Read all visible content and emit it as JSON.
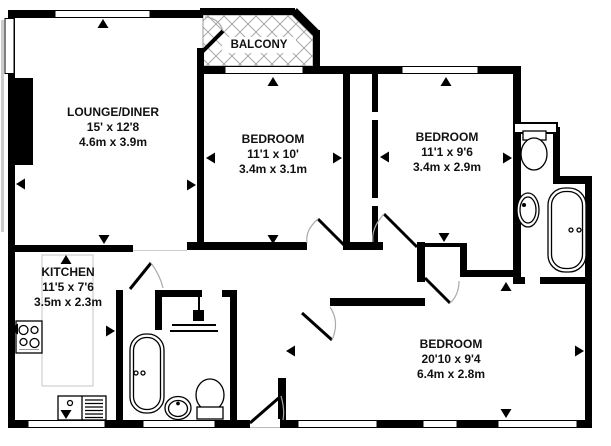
{
  "balcony": {
    "label": "BALCONY"
  },
  "rooms": {
    "lounge": {
      "name": "LOUNGE/DINER",
      "imperial": "15' x 12'8",
      "metric": "4.6m x 3.9m"
    },
    "bedroom1": {
      "name": "BEDROOM",
      "imperial": "11'1 x 10'",
      "metric": "3.4m x 3.1m"
    },
    "bedroom2": {
      "name": "BEDROOM",
      "imperial": "11'1 x 9'6",
      "metric": "3.4m x 2.9m"
    },
    "kitchen": {
      "name": "KITCHEN",
      "imperial": "11'5 x 7'6",
      "metric": "3.5m x 2.3m"
    },
    "bedroom3": {
      "name": "BEDROOM",
      "imperial": "20'10 x 9'4",
      "metric": "6.4m x 2.8m"
    }
  },
  "fixtures": {
    "bathroom": [
      "bathtub",
      "pedestal-sink",
      "toilet",
      "shower"
    ],
    "kitchen": [
      "hob",
      "sink-drainer-unit",
      "counter"
    ],
    "ensuite": [
      "cistern-shelf",
      "toilet",
      "sink",
      "bathtub"
    ]
  },
  "colors": {
    "wall": "#000000",
    "background": "#ffffff",
    "hatch": "#a8a8a8",
    "door_arc": "#aaaaaa",
    "counter_outline": "#c4c4c4"
  }
}
